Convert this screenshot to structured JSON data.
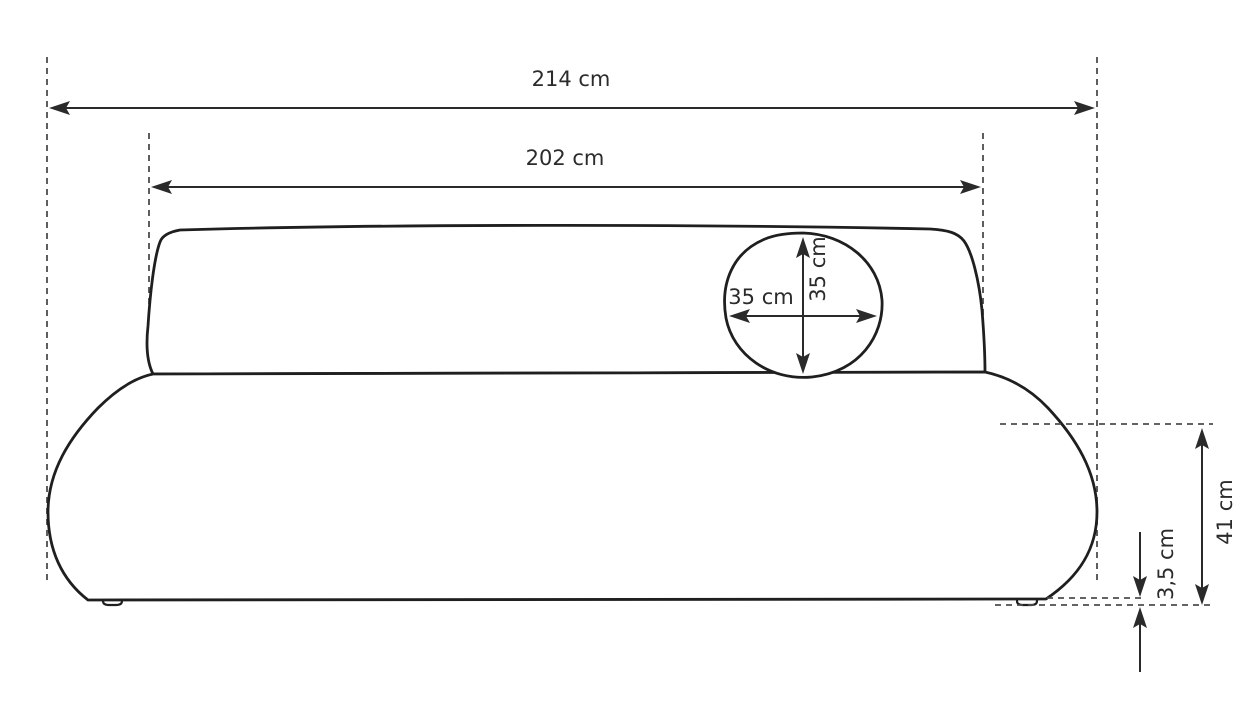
{
  "diagram": {
    "labels": {
      "overall_width": "214 cm",
      "seat_width": "202 cm",
      "pillow_width": "35 cm",
      "pillow_height": "35 cm",
      "base_height": "41 cm",
      "leg_height": "3,5 cm"
    },
    "colors": {
      "background": "#ffffff",
      "outline": "#1f1f1f",
      "dimension_lines": "#2a2a2a",
      "dashed_guides": "#4d4d4d",
      "text": "#2b2b2b"
    }
  }
}
